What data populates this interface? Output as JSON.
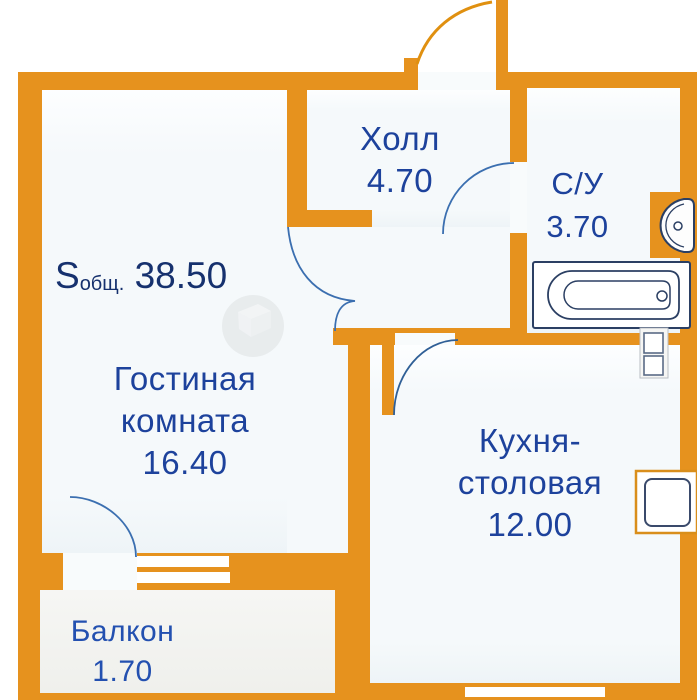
{
  "colors": {
    "wall": "#E6921E",
    "floor": "#F5F9FB",
    "floor-balcony": "#EFF0EC",
    "label": "#1D429C",
    "label-dark": "#16316E",
    "fixture-outline": "#2B3F63",
    "door-arc": "#3B6FB0",
    "entrance-arc": "#E09010",
    "stove-frame": "#D98E1B"
  },
  "total_area": {
    "symbol": "S",
    "subscript": "общ.",
    "value": "38.50"
  },
  "rooms": [
    {
      "id": "hall",
      "lines": [
        "Холл"
      ],
      "area": "4.70"
    },
    {
      "id": "bathroom",
      "lines": [
        "С/У"
      ],
      "area": "3.70"
    },
    {
      "id": "living-room",
      "lines": [
        "Гостиная",
        "комната"
      ],
      "area": "16.40"
    },
    {
      "id": "kitchen-dining",
      "lines": [
        "Кухня-",
        "столовая"
      ],
      "area": "12.00"
    },
    {
      "id": "balcony",
      "lines": [
        "Балкон"
      ],
      "area": "1.70"
    }
  ],
  "fixtures": [
    "bathtub",
    "sink",
    "ventilation-shaft",
    "stove",
    "entrance-door-arc",
    "bathroom-door-arc",
    "living-room-door-arc",
    "kitchen-door-arc",
    "balcony-door-arc",
    "balcony-window",
    "kitchen-window"
  ]
}
